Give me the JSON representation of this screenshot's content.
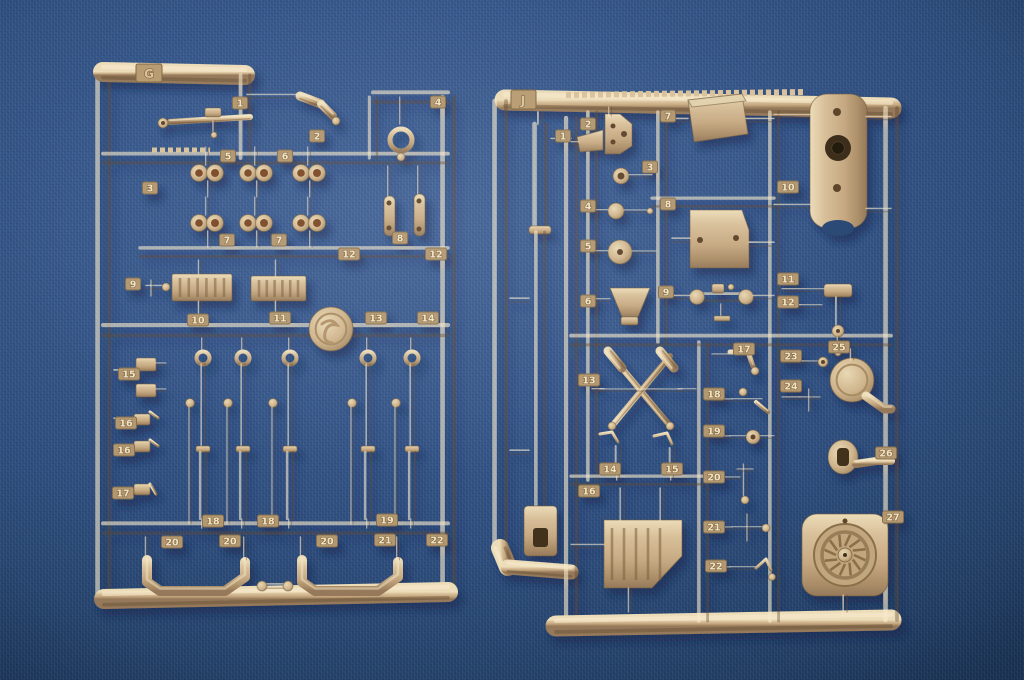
{
  "scene": {
    "subject": "Two tan injection-molded plastic model-kit sprues (part trees) photographed on blue fabric",
    "background_color": "#31527f",
    "vignette_color": "#16304f",
    "plastic_base_color": "#cbb08a",
    "plastic_highlight_color": "#eedfbc",
    "plastic_shadow_color": "#8c7350",
    "tag_plate_color": "#b29770",
    "tag_text_color": "#f0e2c0"
  },
  "left_sprue": {
    "label": "G",
    "tags": [
      {
        "n": "1",
        "x": 240,
        "y": 103
      },
      {
        "n": "2",
        "x": 317,
        "y": 136
      },
      {
        "n": "3",
        "x": 150,
        "y": 188
      },
      {
        "n": "4",
        "x": 438,
        "y": 102
      },
      {
        "n": "5",
        "x": 228,
        "y": 156
      },
      {
        "n": "6",
        "x": 285,
        "y": 156
      },
      {
        "n": "7",
        "x": 227,
        "y": 240
      },
      {
        "n": "7",
        "x": 279,
        "y": 240
      },
      {
        "n": "8",
        "x": 400,
        "y": 238
      },
      {
        "n": "9",
        "x": 133,
        "y": 284
      },
      {
        "n": "10",
        "x": 198,
        "y": 320
      },
      {
        "n": "11",
        "x": 280,
        "y": 318
      },
      {
        "n": "12",
        "x": 349,
        "y": 254
      },
      {
        "n": "12",
        "x": 436,
        "y": 254
      },
      {
        "n": "13",
        "x": 376,
        "y": 318
      },
      {
        "n": "14",
        "x": 428,
        "y": 318
      },
      {
        "n": "15",
        "x": 129,
        "y": 374
      },
      {
        "n": "16",
        "x": 126,
        "y": 423
      },
      {
        "n": "16",
        "x": 124,
        "y": 450
      },
      {
        "n": "17",
        "x": 123,
        "y": 493
      },
      {
        "n": "18",
        "x": 213,
        "y": 521
      },
      {
        "n": "18",
        "x": 268,
        "y": 521
      },
      {
        "n": "19",
        "x": 387,
        "y": 520
      },
      {
        "n": "20",
        "x": 172,
        "y": 542
      },
      {
        "n": "20",
        "x": 230,
        "y": 541
      },
      {
        "n": "20",
        "x": 327,
        "y": 541
      },
      {
        "n": "21",
        "x": 385,
        "y": 540
      },
      {
        "n": "22",
        "x": 437,
        "y": 540
      }
    ]
  },
  "right_sprue": {
    "label": "J",
    "tags": [
      {
        "n": "1",
        "x": 563,
        "y": 136
      },
      {
        "n": "2",
        "x": 588,
        "y": 124
      },
      {
        "n": "3",
        "x": 650,
        "y": 167
      },
      {
        "n": "4",
        "x": 588,
        "y": 206
      },
      {
        "n": "5",
        "x": 588,
        "y": 246
      },
      {
        "n": "6",
        "x": 588,
        "y": 301
      },
      {
        "n": "7",
        "x": 668,
        "y": 116
      },
      {
        "n": "8",
        "x": 668,
        "y": 204
      },
      {
        "n": "9",
        "x": 666,
        "y": 292
      },
      {
        "n": "10",
        "x": 788,
        "y": 187
      },
      {
        "n": "11",
        "x": 788,
        "y": 279
      },
      {
        "n": "12",
        "x": 788,
        "y": 302
      },
      {
        "n": "13",
        "x": 589,
        "y": 380
      },
      {
        "n": "14",
        "x": 610,
        "y": 469
      },
      {
        "n": "15",
        "x": 672,
        "y": 469
      },
      {
        "n": "16",
        "x": 589,
        "y": 491
      },
      {
        "n": "17",
        "x": 744,
        "y": 349
      },
      {
        "n": "18",
        "x": 714,
        "y": 394
      },
      {
        "n": "19",
        "x": 714,
        "y": 431
      },
      {
        "n": "20",
        "x": 714,
        "y": 477
      },
      {
        "n": "21",
        "x": 714,
        "y": 527
      },
      {
        "n": "22",
        "x": 716,
        "y": 566
      },
      {
        "n": "23",
        "x": 791,
        "y": 356
      },
      {
        "n": "24",
        "x": 791,
        "y": 386
      },
      {
        "n": "25",
        "x": 839,
        "y": 347
      },
      {
        "n": "26",
        "x": 886,
        "y": 453
      },
      {
        "n": "27",
        "x": 893,
        "y": 517
      }
    ]
  }
}
